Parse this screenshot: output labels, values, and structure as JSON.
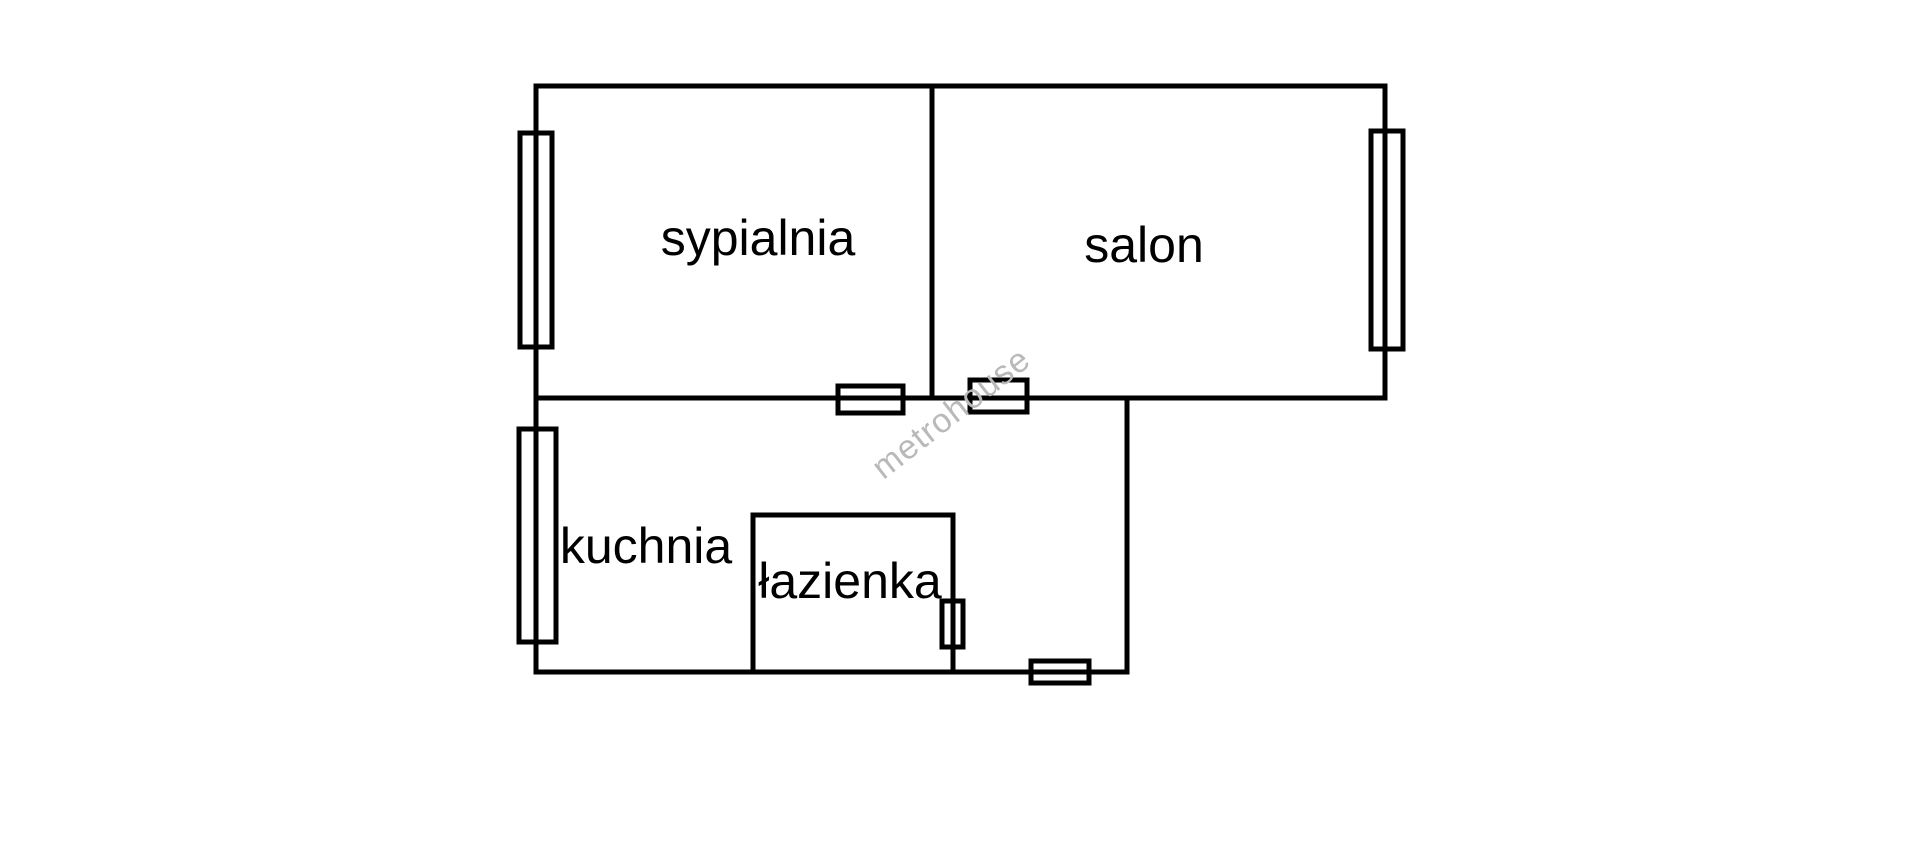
{
  "colors": {
    "background": "#ffffff",
    "line": "#000000",
    "watermark": "#b9b9b9"
  },
  "watermark": {
    "text": "metrohouse",
    "x": 958,
    "y": 422,
    "rotation_deg": -38,
    "font_size": 34
  },
  "floor_plan": {
    "line_width": 5,
    "label_font_size": 50,
    "rooms": [
      {
        "id": "sypialnia",
        "label": "sypialnia",
        "label_x": 758,
        "label_y": 255
      },
      {
        "id": "salon",
        "label": "salon",
        "label_x": 1144,
        "label_y": 262
      },
      {
        "id": "kuchnia",
        "label": "kuchnia",
        "label_x": 646,
        "label_y": 563
      },
      {
        "id": "lazienka",
        "label": "łazienka",
        "label_x": 850,
        "label_y": 598
      }
    ],
    "walls": [
      {
        "name": "wall-top",
        "x1": 536,
        "y1": 86,
        "x2": 1385,
        "y2": 86
      },
      {
        "name": "wall-left-upper",
        "x1": 536,
        "y1": 86,
        "x2": 536,
        "y2": 398
      },
      {
        "name": "wall-right-salon",
        "x1": 1385,
        "y1": 86,
        "x2": 1385,
        "y2": 398
      },
      {
        "name": "wall-divider-sypialnia-salon",
        "x1": 932,
        "y1": 86,
        "x2": 932,
        "y2": 398
      },
      {
        "name": "wall-middle-horizontal",
        "x1": 536,
        "y1": 398,
        "x2": 1385,
        "y2": 398
      },
      {
        "name": "wall-left-lower",
        "x1": 536,
        "y1": 398,
        "x2": 536,
        "y2": 672
      },
      {
        "name": "wall-bottom",
        "x1": 536,
        "y1": 672,
        "x2": 1127,
        "y2": 672
      },
      {
        "name": "wall-right-lower",
        "x1": 1127,
        "y1": 398,
        "x2": 1127,
        "y2": 672
      },
      {
        "name": "wall-lazienka-top",
        "x1": 753,
        "y1": 515,
        "x2": 953,
        "y2": 515
      },
      {
        "name": "wall-lazienka-left",
        "x1": 753,
        "y1": 515,
        "x2": 753,
        "y2": 672
      },
      {
        "name": "wall-lazienka-right",
        "x1": 953,
        "y1": 515,
        "x2": 953,
        "y2": 672
      }
    ],
    "windows": [
      {
        "name": "window-sypialnia",
        "x": 520,
        "y": 133,
        "width": 32,
        "height": 214
      },
      {
        "name": "window-salon",
        "x": 1371,
        "y": 131,
        "width": 32,
        "height": 218
      },
      {
        "name": "window-kuchnia",
        "x": 519,
        "y": 429,
        "width": 37,
        "height": 213
      }
    ],
    "doors": [
      {
        "name": "door-sypialnia",
        "x": 838,
        "y": 386,
        "width": 65,
        "height": 27
      },
      {
        "name": "door-salon",
        "x": 970,
        "y": 380,
        "width": 57,
        "height": 32
      },
      {
        "name": "door-lazienka",
        "x": 942,
        "y": 601,
        "width": 21,
        "height": 46
      },
      {
        "name": "door-bottom",
        "x": 1031,
        "y": 661,
        "width": 58,
        "height": 22
      }
    ]
  }
}
